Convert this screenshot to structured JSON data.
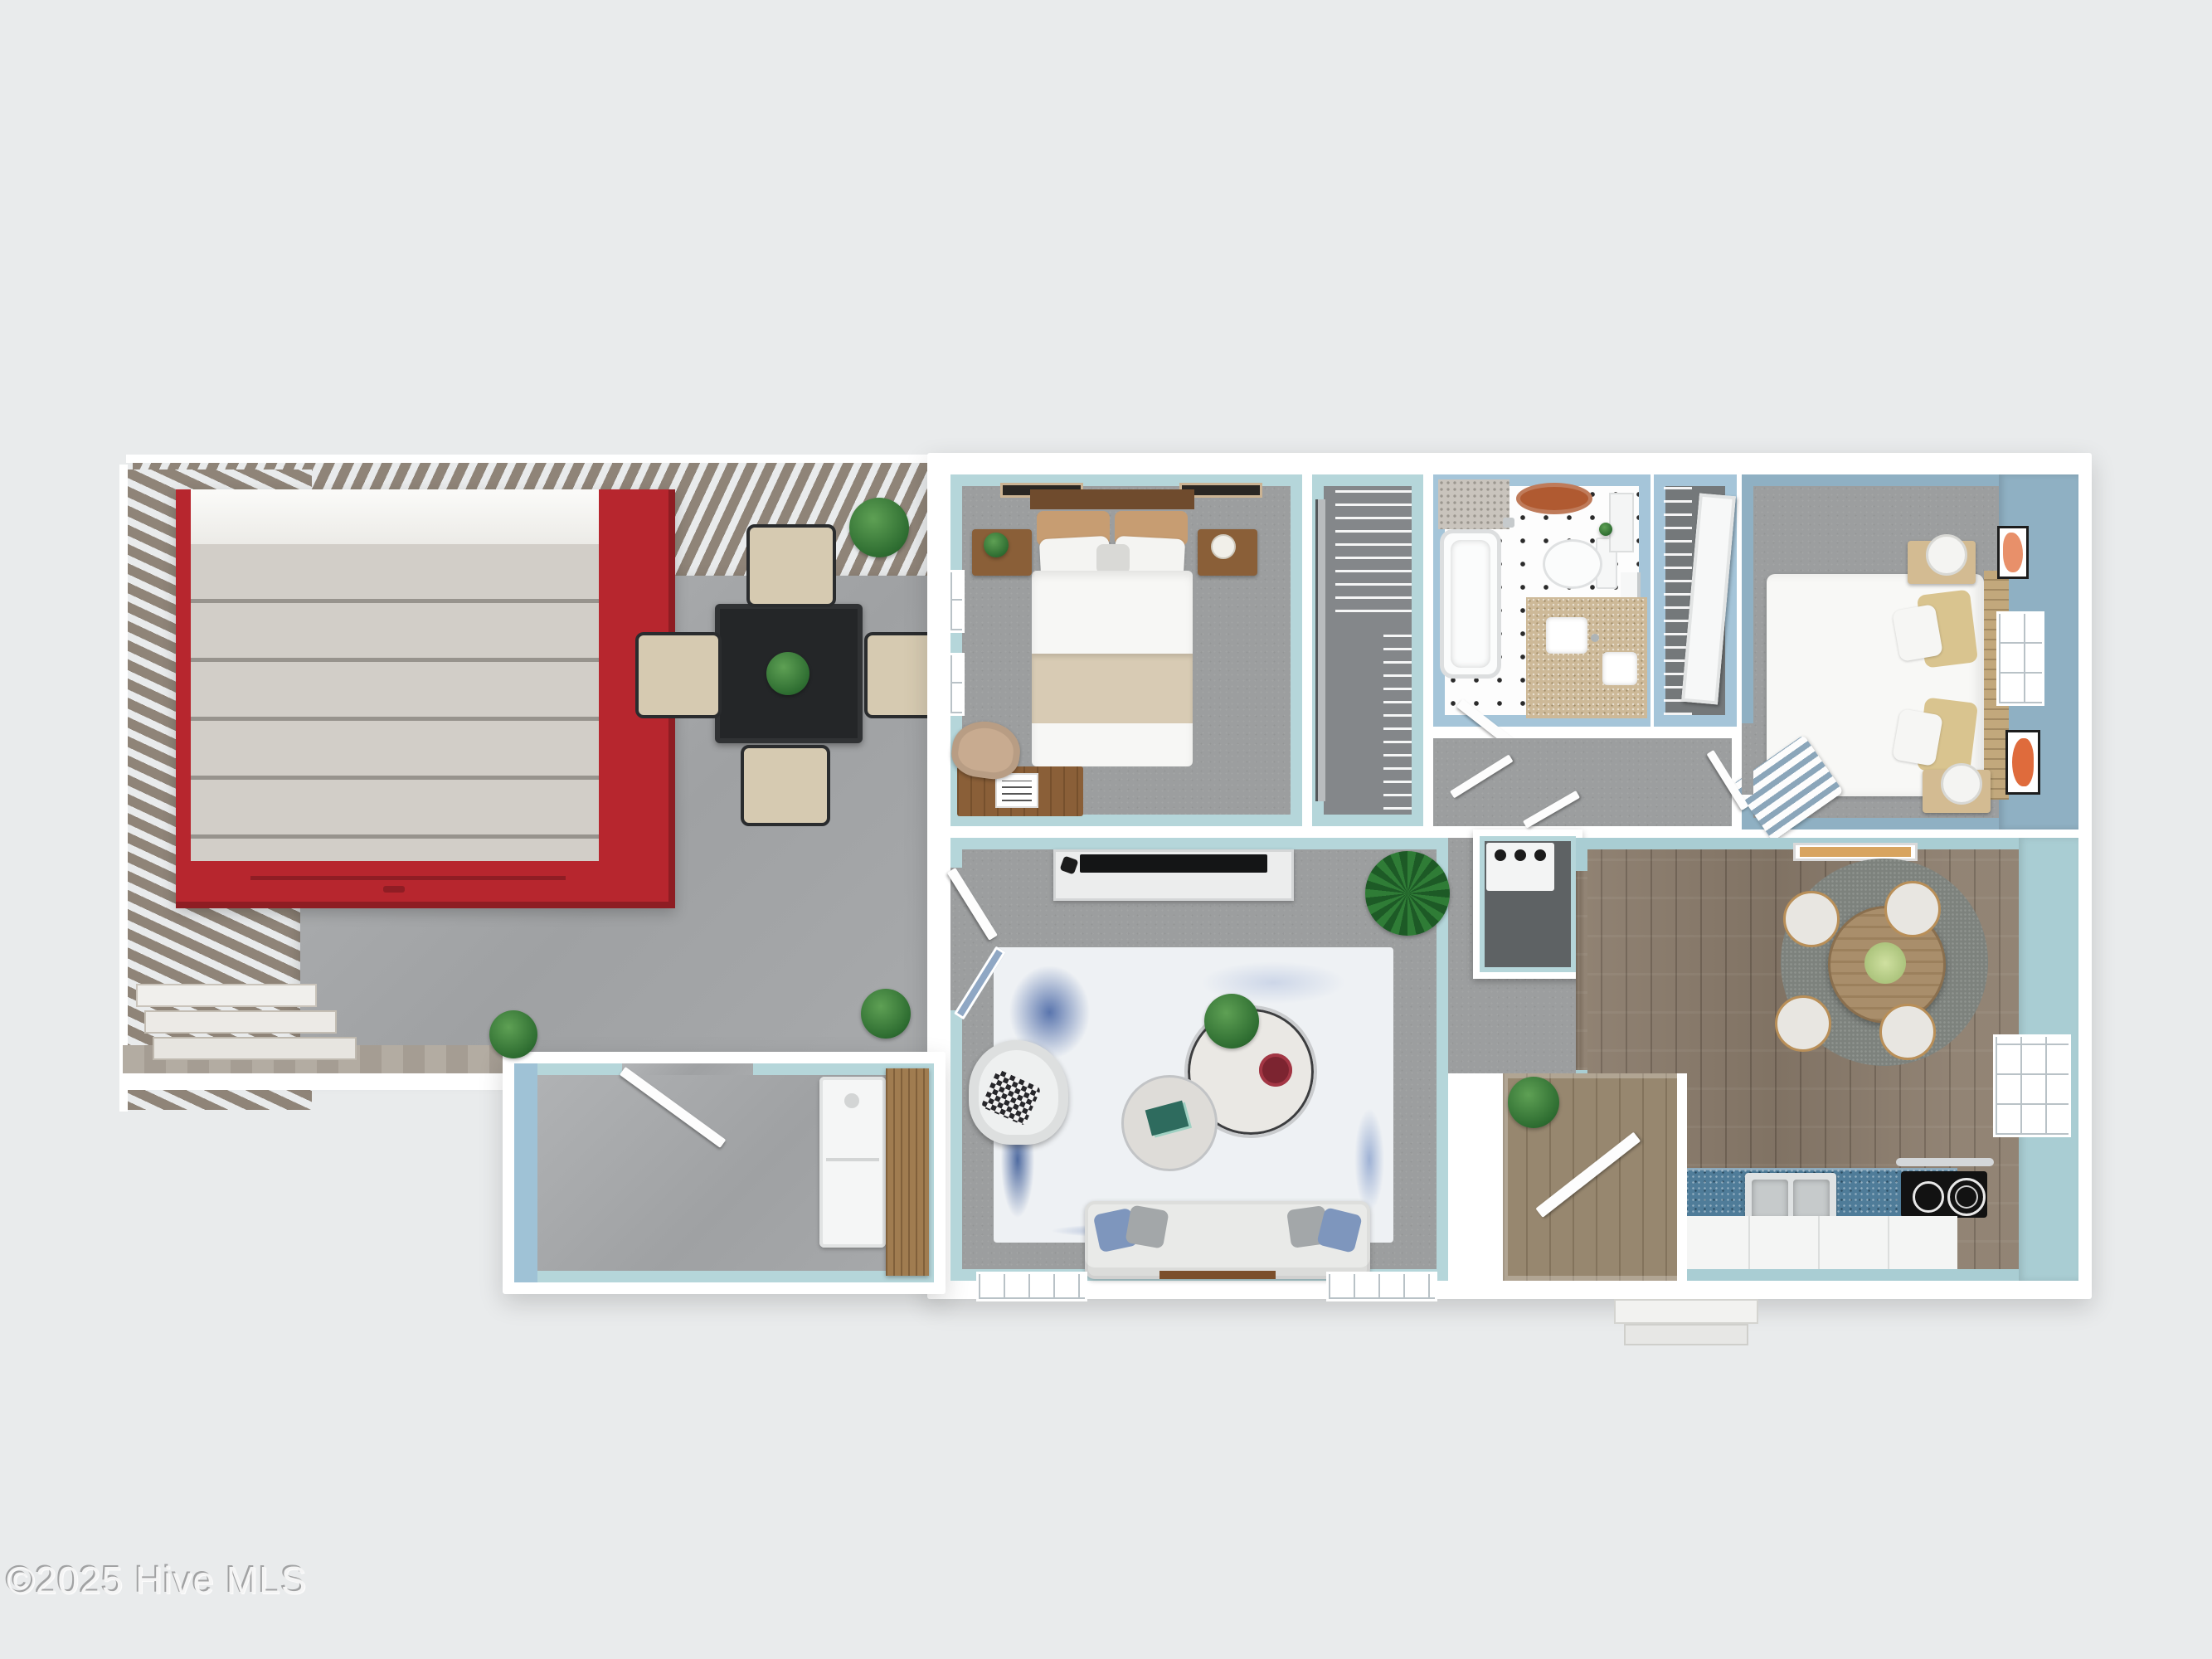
{
  "watermark": {
    "text": "©2025 Hive MLS"
  },
  "colors": {
    "bg": "#e9ebec",
    "wall": "#ffffff",
    "teal": "#b5d6da",
    "teal_deep": "#a9cdd3",
    "bath_blue": "#a5c5d9",
    "slate": "#8fb0c3",
    "pale_blue": "#9fc2d6",
    "carpet": "#9c9e9f",
    "floor_dark": "#84878a",
    "concrete": "#a9abad",
    "wood": "#8b7c6c",
    "wood_light": "#97876f",
    "oak": "#a07c50",
    "slat": "#8f8478",
    "shed_red": "#b7262e",
    "shed_red_dark": "#8f1d24",
    "shingle": "#c8c4be",
    "counter_blue": "#4f7c99",
    "vanity_tan": "#cdb998",
    "rug_blue": "#4a68a6",
    "rug_base": "#eef1f4",
    "sofa": "#e9eae8",
    "tv": "#141516",
    "chair_beige": "#d6cab1",
    "table_black": "#242628",
    "plant": "#3c8140",
    "mat_rust": "#b05a31",
    "frame_orange": "#e8906a",
    "watermark": "#f5f5f5"
  },
  "scene": {
    "type": "3d-floor-plan-render",
    "rooms": [
      "deck",
      "shed",
      "bedroom-1",
      "walk-in-closet",
      "bathroom",
      "hall-closet",
      "bedroom-2",
      "hallway",
      "mechanical-closet",
      "living-room",
      "entry-hall",
      "kitchen-dining",
      "laundry-room"
    ]
  }
}
